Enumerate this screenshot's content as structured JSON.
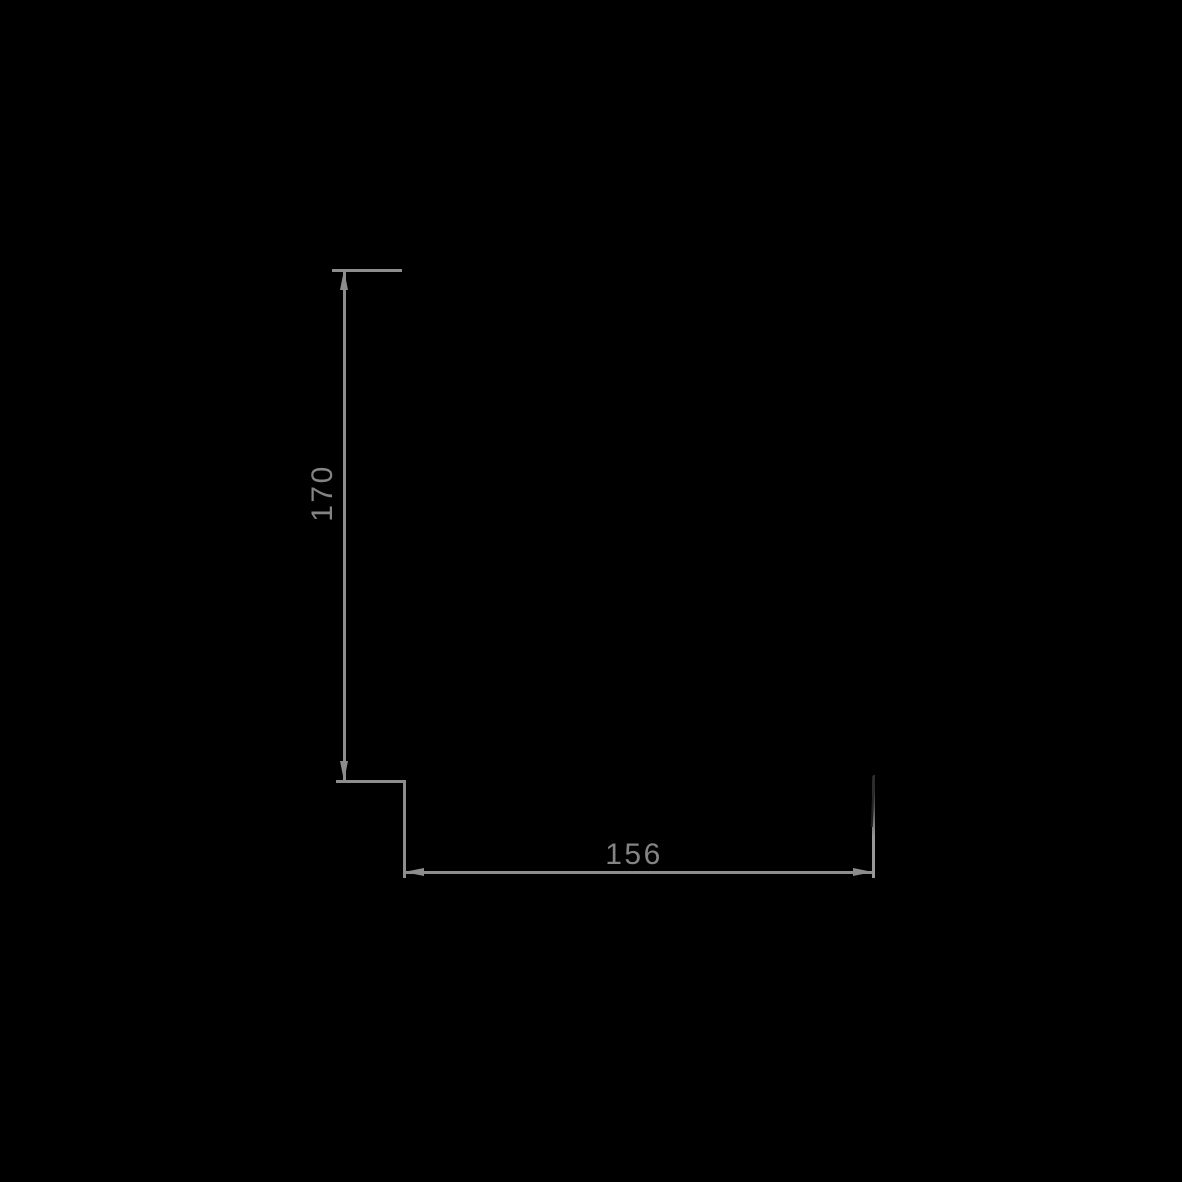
{
  "drawing": {
    "type": "technical-drawing-dimensions",
    "background_color": "#000000",
    "line_color": "#8d8d8d",
    "label_color": "#848484",
    "dimensions": [
      {
        "id": "vertical-dimension",
        "value": "170",
        "orientation": "vertical"
      },
      {
        "id": "horizontal-dimension",
        "value": "156",
        "orientation": "horizontal"
      }
    ],
    "icons": {
      "arrow_up": "filled-triangle-up",
      "arrow_down": "filled-triangle-down",
      "arrow_left": "filled-triangle-left",
      "arrow_right": "filled-triangle-right"
    }
  }
}
